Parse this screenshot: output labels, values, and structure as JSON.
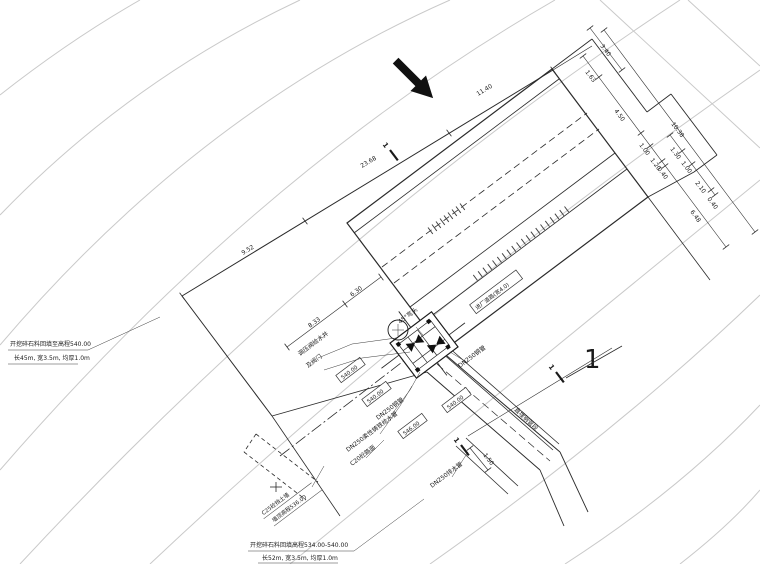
{
  "notes": {
    "left1": "开挖碎石料回填至高程540.00",
    "left2": "长45m, 宽3.5m, 均厚1.0m",
    "bottom1": "开挖碎石料回填高程534.00-540.00",
    "bottom2": "长52m, 宽3.5m, 均厚1.0m",
    "wall1": "C25砼挡土墙",
    "wall2": "墙顶高程536.00"
  },
  "labels": {
    "valve_well_line1": "调压阀给水井",
    "valve_well_line2": "及阀门",
    "elbow": "45°弯头",
    "steel_pipe_a": "DN250钢管",
    "steel_pipe_b": "DN250钢管",
    "ductile_pipe": "DN250柔性铸铁给水管",
    "drain_pipe": "DN250排水管",
    "road": "进厂道路(宽4.0)",
    "pavement": "C20砼路面",
    "buried_pipe": "直埋钢管段"
  },
  "elevations": {
    "e1": "540.00",
    "e2": "540.00",
    "e3": "546.00",
    "e4": "540.00"
  },
  "dims": {
    "d952": "9.52",
    "d2368": "23.68",
    "d1140": "11.40",
    "d833": "8.33",
    "d630": "6.30",
    "d340": "3.40",
    "d1038": "10.38",
    "d163": "1.63",
    "d450": "4.50",
    "d100a": "1.00",
    "d120": "1.20",
    "d040a": "0.40",
    "d648": "6.48",
    "d130": "1.30",
    "d100b": "1.00",
    "d210": "2.10",
    "d040b": "0.40",
    "d150": "1.50"
  },
  "section": {
    "num": "1"
  }
}
